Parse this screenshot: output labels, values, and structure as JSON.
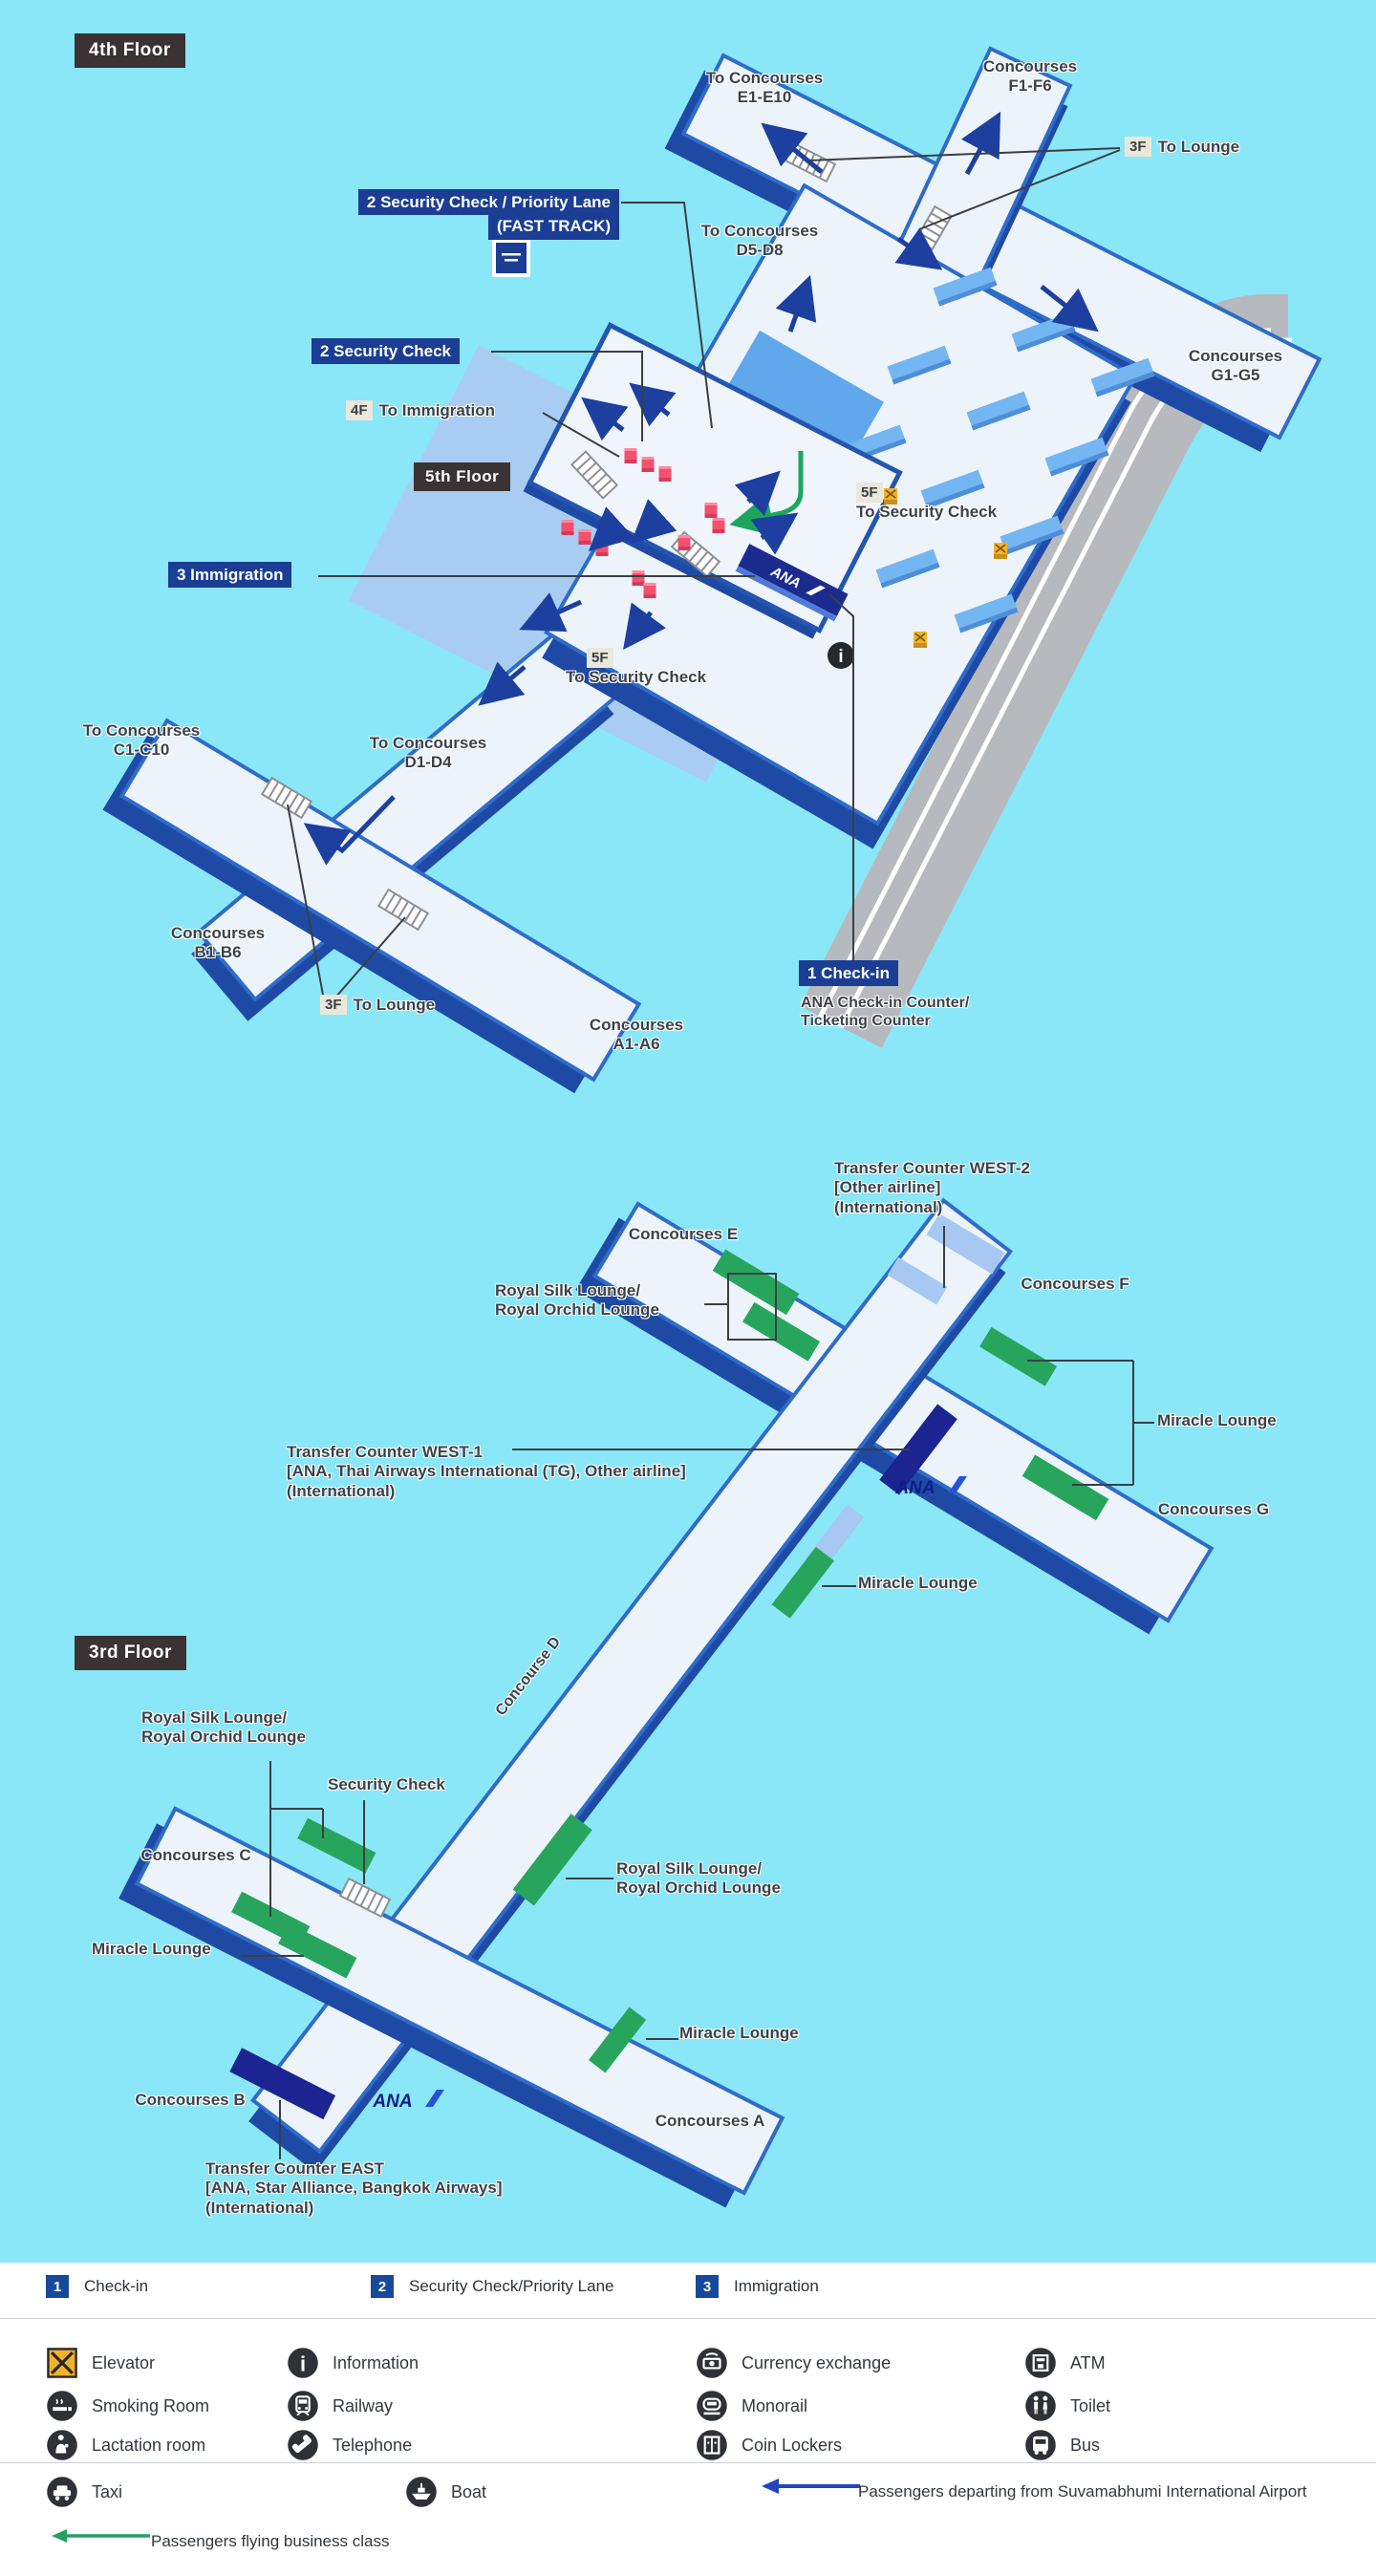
{
  "map_4f": {
    "badge": "4th Floor",
    "inset_badge": "5th Floor",
    "to_concourses_e": "To Concourses\nE1-E10",
    "concourses_f": "Concourses\nF1-F6",
    "lounge_top_chip": "3F",
    "lounge_top_text": "To Lounge",
    "sec_priority_l1": "2 Security Check / Priority Lane",
    "sec_priority_l2": "(FAST TRACK)",
    "to_concourses_d58": "To Concourses\nD5-D8",
    "concourses_g": "Concourses\nG1-G5",
    "security": "2 Security Check",
    "imm_chip": "4F",
    "imm_text": "To Immigration",
    "sec_r_chip": "5F",
    "sec_r_text": "To Security Check",
    "immigration": "3 Immigration",
    "sec_l_chip": "5F",
    "sec_l_text": "To Security Check",
    "to_concourses_c": "To Concourses\nC1-C10",
    "to_concourses_d14": "To Concourses\nD1-D4",
    "concourses_b": "Concourses\nB1-B6",
    "lounge_bottom_chip": "3F",
    "lounge_bottom_text": "To Lounge",
    "concourses_a": "Concourses\nA1-A6",
    "checkin": "1 Check-in",
    "checkin_desc": "ANA Check-in Counter/\nTicketing Counter",
    "ana": "ANA"
  },
  "map_3f": {
    "badge": "3rd Floor",
    "transfer_west2": "Transfer Counter WEST-2\n[Other airline]\n(International)",
    "concourses_e": "Concourses E",
    "concourses_f": "Concourses F",
    "royal_silk_nw": "Royal Silk Lounge/\nRoyal Orchid Lounge",
    "miracle_e": "Miracle Lounge",
    "transfer_west1": "Transfer Counter WEST-1\n [ANA, Thai Airways International (TG), Other airline]\n(International)",
    "concourses_g": "Concourses G",
    "miracle_mid": "Miracle Lounge",
    "concourse_d": "Concourse D",
    "royal_silk_w": "Royal Silk Lounge/\nRoyal Orchid Lounge",
    "security_check": "Security Check",
    "concourses_c": "Concourses C",
    "miracle_w": "Miracle Lounge",
    "royal_silk_e": "Royal Silk Lounge/\nRoyal Orchid Lounge",
    "miracle_s": "Miracle Lounge",
    "concourses_b": "Concourses B",
    "concourses_a": "Concourses A",
    "transfer_east": "Transfer Counter EAST\n[ANA, Star Alliance, Bangkok Airways]\n(International)",
    "ana": "ANA"
  },
  "legend": {
    "numbered": [
      {
        "num": "1",
        "label": "Check-in"
      },
      {
        "num": "2",
        "label": "Security Check/Priority Lane"
      },
      {
        "num": "3",
        "label": "Immigration"
      }
    ],
    "facilities": [
      {
        "icon": "elevator-icon",
        "label": "Elevator"
      },
      {
        "icon": "information-icon",
        "label": "Information"
      },
      {
        "icon": "currency-exchange-icon",
        "label": "Currency exchange"
      },
      {
        "icon": "atm-icon",
        "label": "ATM"
      },
      {
        "icon": "smoking-room-icon",
        "label": "Smoking Room"
      },
      {
        "icon": "railway-icon",
        "label": "Railway"
      },
      {
        "icon": "monorail-icon",
        "label": "Monorail"
      },
      {
        "icon": "toilet-icon",
        "label": "Toilet"
      },
      {
        "icon": "lactation-room-icon",
        "label": "Lactation room"
      },
      {
        "icon": "telephone-icon",
        "label": "Telephone"
      },
      {
        "icon": "coin-lockers-icon",
        "label": "Coin Lockers"
      },
      {
        "icon": "bus-icon",
        "label": "Bus"
      },
      {
        "icon": "taxi-icon",
        "label": "Taxi"
      },
      {
        "icon": "boat-icon",
        "label": "Boat"
      }
    ],
    "departing": "Passengers departing from Suvamabhumi International Airport",
    "business": "Passengers flying business class"
  },
  "icons": {
    "info_glyph": "i"
  },
  "colors": {
    "background": "#8ae7f8",
    "corridor_fill": "#edf3fa",
    "corridor_edge": "#2f6cc8",
    "corridor_shadow": "#1e4aa6",
    "label_navy": "#1b3e94",
    "floor_badge": "#3a3233",
    "lounge_green": "#28a55c",
    "counter_blue": "#74b6f2",
    "transfer_navy": "#1b2b8e",
    "security_pink": "#f2516f",
    "elevator_yellow": "#f3b229",
    "road_gray": "#b6babe"
  }
}
